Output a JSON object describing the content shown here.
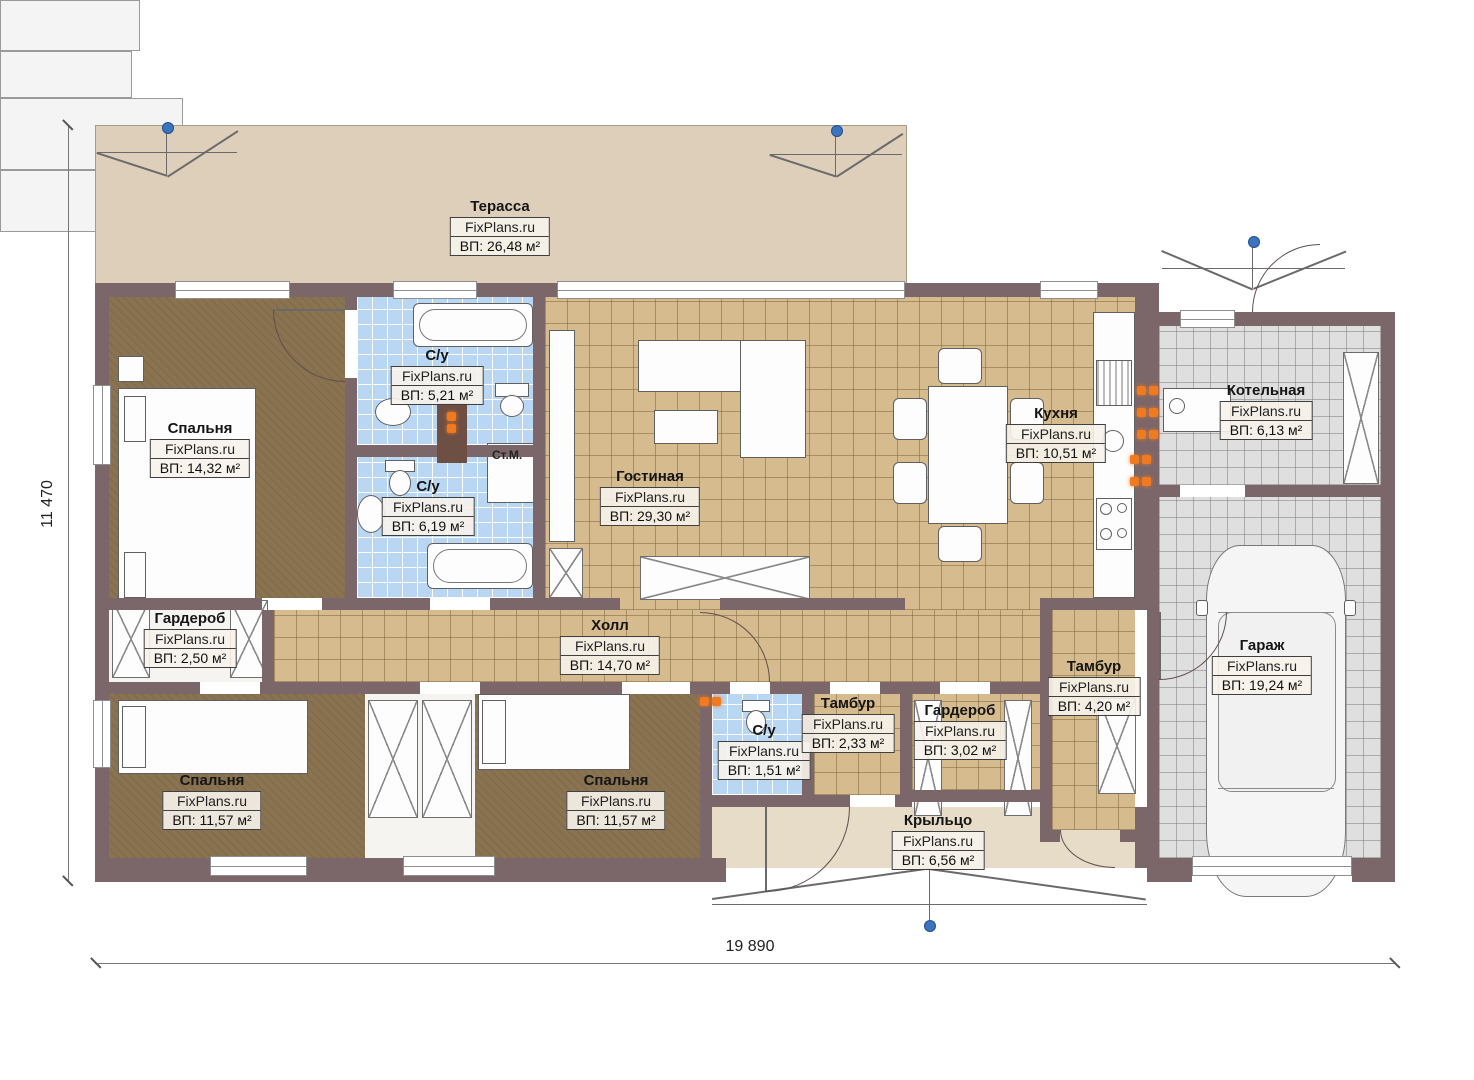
{
  "watermark": "FixPlans.ru",
  "dimensions": {
    "height_label": "11 470",
    "width_label": "19 890"
  },
  "washing_machine_label": "Ст.М.",
  "rooms": [
    {
      "id": "terrace",
      "name": "Терасса",
      "area": "ВП: 26,48 м²"
    },
    {
      "id": "bedroom-1",
      "name": "Спальня",
      "area": "ВП: 14,32 м²"
    },
    {
      "id": "bath-1",
      "name": "С/у",
      "area": "ВП: 5,21 м²"
    },
    {
      "id": "bath-2",
      "name": "С/у",
      "area": "ВП: 6,19 м²"
    },
    {
      "id": "living-room",
      "name": "Гостиная",
      "area": "ВП: 29,30 м²"
    },
    {
      "id": "kitchen",
      "name": "Кухня",
      "area": "ВП: 10,51 м²"
    },
    {
      "id": "boiler-room",
      "name": "Котельная",
      "area": "ВП: 6,13 м²"
    },
    {
      "id": "wardrobe-1",
      "name": "Гардероб",
      "area": "ВП: 2,50 м²"
    },
    {
      "id": "hall",
      "name": "Холл",
      "area": "ВП: 14,70 м²"
    },
    {
      "id": "garage",
      "name": "Гараж",
      "area": "ВП: 19,24 м²"
    },
    {
      "id": "bedroom-2",
      "name": "Спальня",
      "area": "ВП: 11,57 м²"
    },
    {
      "id": "bedroom-3",
      "name": "Спальня",
      "area": "ВП: 11,57 м²"
    },
    {
      "id": "bath-3",
      "name": "С/у",
      "area": "ВП: 1,51 м²"
    },
    {
      "id": "vestibule-1",
      "name": "Тамбур",
      "area": "ВП: 2,33 м²"
    },
    {
      "id": "wardrobe-2",
      "name": "Гардероб",
      "area": "ВП: 3,02 м²"
    },
    {
      "id": "vestibule-2",
      "name": "Тамбур",
      "area": "ВП: 4,20 м²"
    },
    {
      "id": "porch",
      "name": "Крыльцо",
      "area": "ВП: 6,56 м²"
    }
  ],
  "colors": {
    "wall": "#7b6669",
    "terrace": "#ddcfba",
    "bedroom_floor": "#8a7350",
    "tile_tan": "#d5bb8d",
    "tile_blue": "#b9d6f2",
    "tile_gray": "#e0dfdf",
    "radiator_orange": "#f07a20",
    "marker_blue": "#3b74bc"
  }
}
